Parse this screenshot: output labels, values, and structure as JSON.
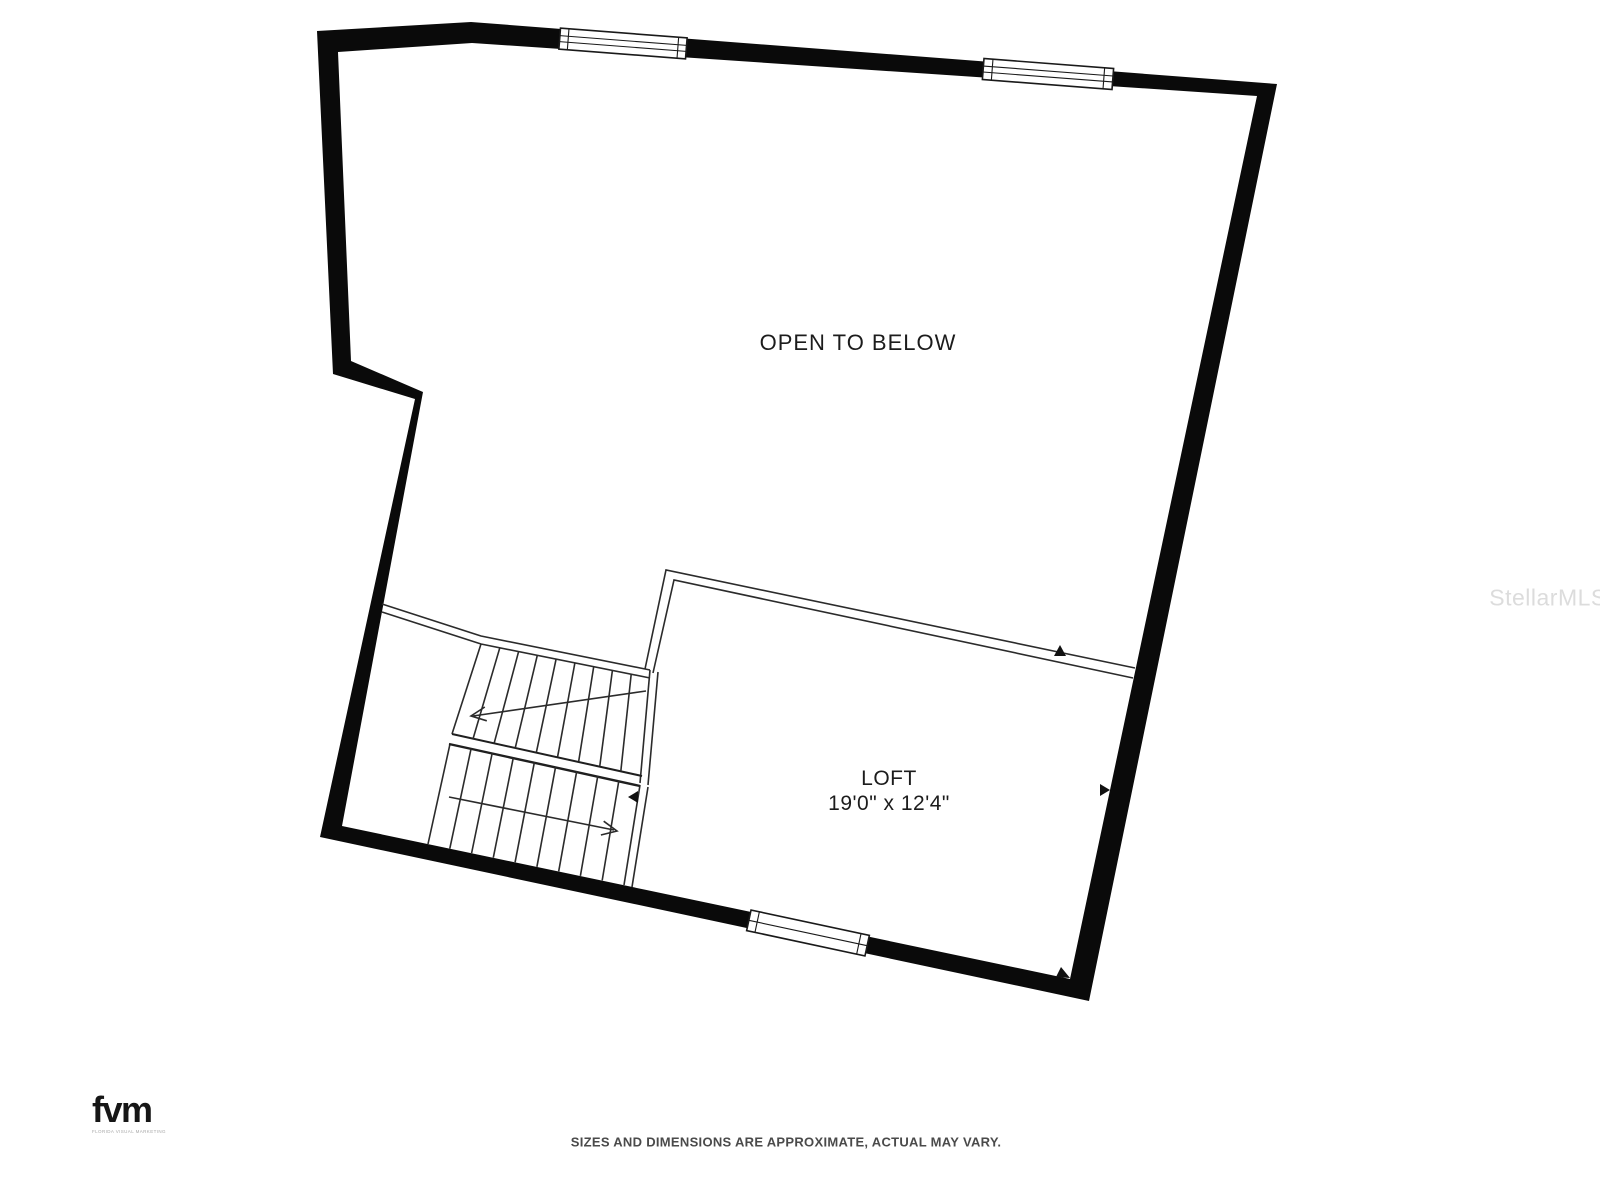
{
  "labels": {
    "open_to_below": "OPEN TO BELOW",
    "loft": "LOFT",
    "loft_dimensions": "19'0\" x 12'4\""
  },
  "watermark": {
    "text": "StellarMLS"
  },
  "branding": {
    "logo_text": "fvm",
    "logo_subtext": "FLORIDA VISUAL MARKETING"
  },
  "footer": {
    "disclaimer": "SIZES AND DIMENSIONS ARE APPROXIMATE, ACTUAL MAY VARY."
  },
  "colors": {
    "background": "#ffffff",
    "wall": "#0a0a0a",
    "line": "#2b2b2b",
    "text": "#1c1c1c",
    "watermark": "#dcdcdc"
  }
}
